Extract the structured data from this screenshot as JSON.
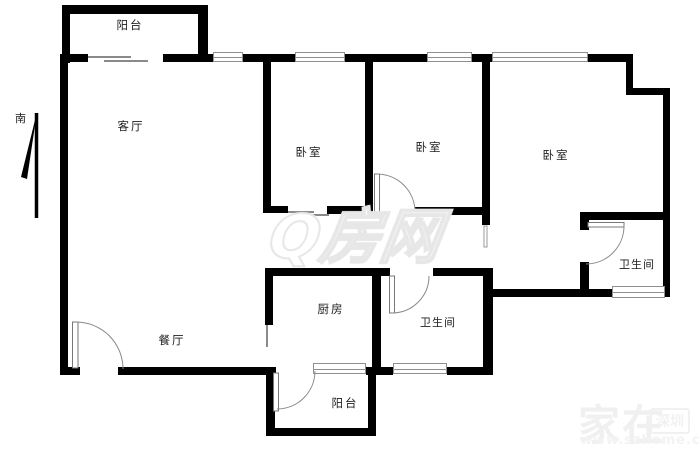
{
  "compass": {
    "south_label": "南"
  },
  "rooms": {
    "balcony_top": "阳台",
    "living": "客厅",
    "bedroom1": "卧室",
    "bedroom2": "卧室",
    "bedroom3": "卧室",
    "dining": "餐厅",
    "kitchen": "厨房",
    "bath_mid": "卫生间",
    "bath_right": "卫生间",
    "balcony_bottom": "阳台"
  },
  "watermarks": {
    "center_logo": "Q房网",
    "corner_main": "家在",
    "corner_badge": "深圳",
    "corner_sub": "www.szhome.com"
  },
  "colors": {
    "wall": "#000000",
    "door_arc": "#888888",
    "window_frame": "#8f8f8f",
    "watermark_center": "#e7e7e7",
    "watermark_corner": "#f0f0f0",
    "background": "#ffffff"
  }
}
